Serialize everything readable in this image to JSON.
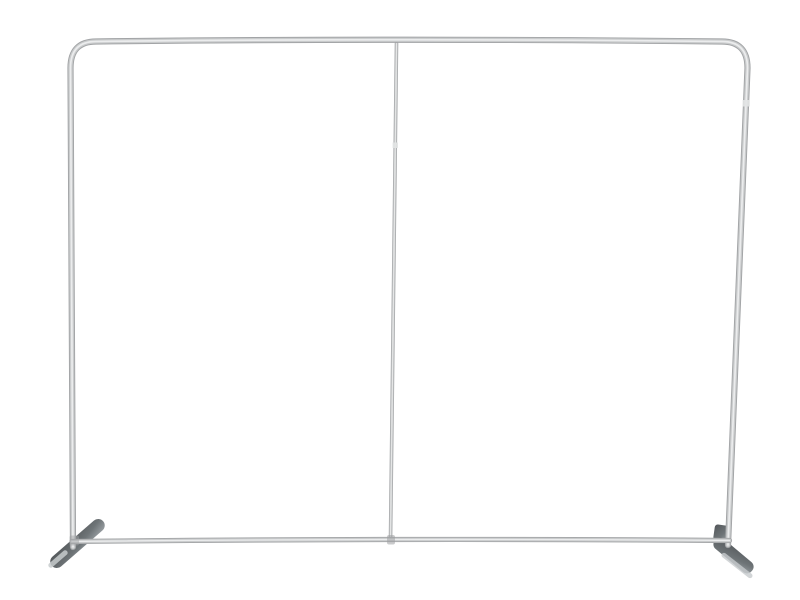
{
  "scene": {
    "type": "product-photo",
    "subject": "Empty aluminum straight tube display backdrop frame with rounded top corners, a thin center support pole, a bottom crossbar and two dark angled stabilizer feet, photographed on a seamless white background"
  },
  "colors": {
    "background": "#ffffff",
    "tube_edge": "#a2a4a6",
    "tube_mid": "#c9cbcc",
    "tube_highlight": "#ebeced",
    "pole_edge": "#a6a8aa",
    "pole_mid": "#cdcfd0",
    "pole_highlight": "#e9eaea",
    "joint_highlight": "#e2e4e4",
    "junction_shade": "#9fa1a3",
    "foot_dark": "#53575a",
    "foot_mid": "#6e7477",
    "foot_light": "#9aa0a4",
    "foot_highlight": "#c7cbcd"
  }
}
